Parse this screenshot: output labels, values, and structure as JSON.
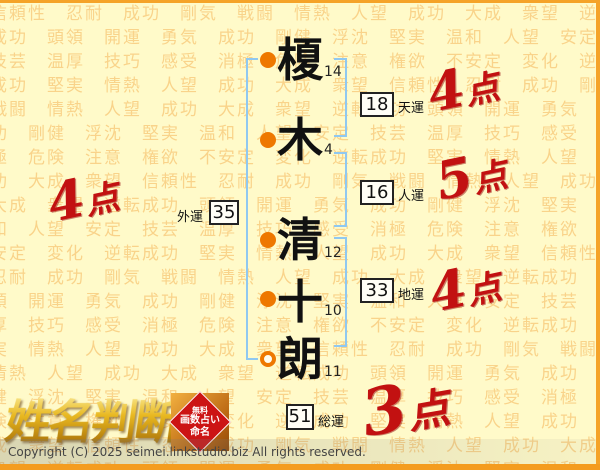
{
  "page": {
    "logo_text": "姓名判断",
    "copyright": "Copyright (C) 2025 seimei.linkstudio.biz All rights reserved."
  },
  "seal": {
    "line1": "無料",
    "line2": "画数占い",
    "line3": "命名"
  },
  "name": {
    "full": "榎木清十朗",
    "characters": [
      {
        "char": "榎",
        "strokes": "14",
        "bullet": "filled"
      },
      {
        "char": "木",
        "strokes": "4",
        "bullet": "filled"
      },
      {
        "char": "清",
        "strokes": "12",
        "bullet": "filled"
      },
      {
        "char": "十",
        "strokes": "10",
        "bullet": "filled"
      },
      {
        "char": "朗",
        "strokes": "11",
        "bullet": "hollow"
      }
    ]
  },
  "fortunes": [
    {
      "id": "tenun",
      "label": "天運",
      "value": "18",
      "score_value": "4",
      "score_unit": "点"
    },
    {
      "id": "jinun",
      "label": "人運",
      "value": "16",
      "score_value": "5",
      "score_unit": "点"
    },
    {
      "id": "gaiun",
      "label": "外運",
      "value": "35",
      "score_value": "4",
      "score_unit": "点"
    },
    {
      "id": "chiun",
      "label": "地運",
      "value": "33",
      "score_value": "4",
      "score_unit": "点"
    },
    {
      "id": "souun",
      "label": "総運",
      "value": "51",
      "score_value": "3",
      "score_unit": "点"
    }
  ],
  "background": {
    "words": [
      "信頼性",
      "忍耐",
      "成功",
      "剛気",
      "戦闘",
      "情熱",
      "人望",
      "成功",
      "大成",
      "衆望",
      "逆転成功",
      "頭領",
      "開運",
      "勇気",
      "成功",
      "剛健",
      "浮沈",
      "堅実",
      "温和",
      "人望",
      "安定",
      "技芸",
      "温厚",
      "技巧",
      "感受",
      "消極",
      "危険",
      "注意",
      "権欲",
      "不安定",
      "変化",
      "逆転成功",
      "堅実",
      "情熱",
      "人望",
      "成功",
      "大成",
      "衆望"
    ],
    "repeat": 12
  },
  "colors": {
    "page_background": "#FFFAC9",
    "pattern_text": "#F5B558",
    "frame_orange": "#F5A328",
    "bullet_orange": "#EE7800",
    "bracket_blue": "#90C8F0",
    "score_red": "#C21111",
    "logo_gold": "#E8B820",
    "seal_red": "#CC1414"
  }
}
